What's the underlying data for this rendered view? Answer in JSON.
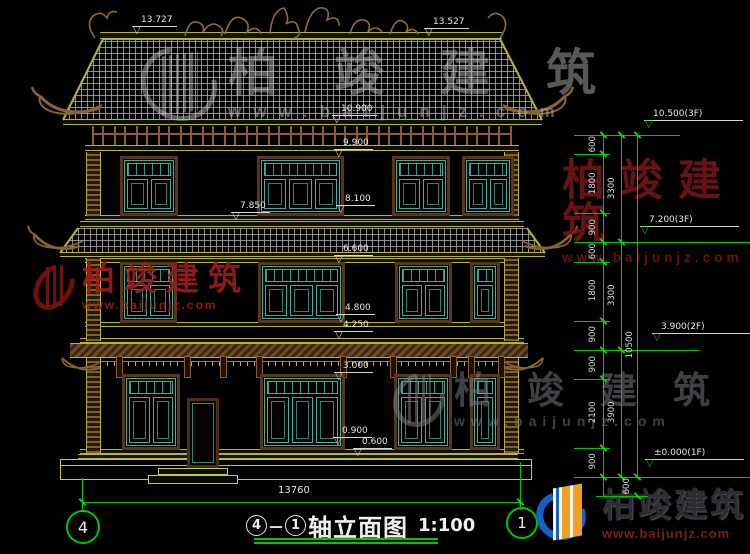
{
  "drawing": {
    "title_axis_start": "4",
    "title_dash": "－",
    "title_axis_end": "1",
    "title_text": "轴立面图",
    "title_scale": "1:100",
    "axis_bubble_left": "4",
    "axis_bubble_right": "1",
    "overall_width_dim": "13760",
    "elevation_marks_building": [
      "13.727",
      "13.527",
      "10.900",
      "9.900",
      "8.100",
      "7.850",
      "6.600",
      "4.800",
      "4.250",
      "3.000",
      "0.900",
      "0.600"
    ],
    "elevation_marks_right": [
      "10.500(3F)",
      "7.200(3F)",
      "3.900(2F)",
      "±0.000(1F)"
    ],
    "dim_chain_inner": [
      "600",
      "1800",
      "900",
      "600",
      "1800",
      "900",
      "900",
      "2100",
      "900"
    ],
    "dim_chain_middle": [
      "3300",
      "3300",
      "3900"
    ],
    "dim_chain_outer": [
      "10500"
    ],
    "dim_below_ground": "600",
    "colors": {
      "dimension_green": "#00c800",
      "text_white": "#e6e6e6",
      "roof_olive": "#b6b236",
      "frame_brown": "#583618",
      "lattice_teal": "#3fae9f",
      "watermark_red": "#9c1c1c",
      "watermark_gray": "#9a9a9a"
    }
  },
  "watermark": {
    "brand": "柏竣建筑",
    "url": "www.baijunjz.com"
  }
}
